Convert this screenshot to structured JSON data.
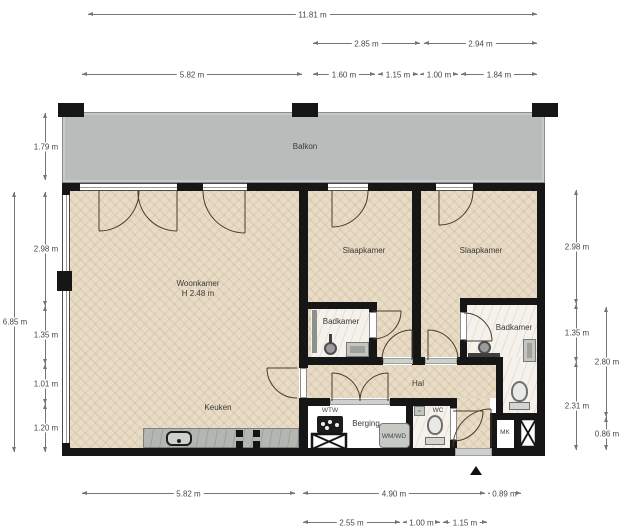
{
  "plan": {
    "type": "apartment-floorplan",
    "rooms": [
      {
        "id": "balkon",
        "label": "Balkon",
        "x": 305,
        "y": 147,
        "small": false
      },
      {
        "id": "woonkamer",
        "label": "Woonkamer",
        "sub": "H 2.48 m",
        "x": 198,
        "y": 289,
        "small": false
      },
      {
        "id": "slaapkamer-1",
        "label": "Slaapkamer",
        "x": 364,
        "y": 251,
        "small": false
      },
      {
        "id": "slaapkamer-2",
        "label": "Slaapkamer",
        "x": 481,
        "y": 251,
        "small": false
      },
      {
        "id": "badkamer-1",
        "label": "Badkamer",
        "x": 341,
        "y": 322,
        "small": false
      },
      {
        "id": "badkamer-2",
        "label": "Badkamer",
        "x": 514,
        "y": 328,
        "small": false
      },
      {
        "id": "keuken",
        "label": "Keuken",
        "x": 218,
        "y": 408,
        "small": false
      },
      {
        "id": "hal",
        "label": "Hal",
        "x": 418,
        "y": 384,
        "small": false
      },
      {
        "id": "wtw",
        "label": "WTW",
        "x": 330,
        "y": 411,
        "small": true
      },
      {
        "id": "berging",
        "label": "Berging",
        "x": 366,
        "y": 424,
        "small": false
      },
      {
        "id": "wmwd",
        "label": "WM/WD",
        "x": 394,
        "y": 437,
        "small": true
      },
      {
        "id": "wc",
        "label": "WC",
        "x": 438,
        "y": 411,
        "small": true
      },
      {
        "id": "mk",
        "label": "MK",
        "x": 505,
        "y": 433,
        "small": true
      }
    ],
    "ceiling_height_note": "H 2.48 m"
  },
  "dimensions": {
    "top": [
      {
        "label": "11.81 m",
        "x1": 88,
        "x2": 537,
        "y": 14
      },
      {
        "label": "2.85 m",
        "x1": 313,
        "x2": 420,
        "y": 43
      },
      {
        "label": "2.94 m",
        "x1": 424,
        "x2": 537,
        "y": 43
      },
      {
        "label": "5.82 m",
        "x1": 82,
        "x2": 302,
        "y": 74
      },
      {
        "label": "1.60 m",
        "x1": 313,
        "x2": 375,
        "y": 74
      },
      {
        "label": "1.15 m",
        "x1": 378,
        "x2": 418,
        "y": 74
      },
      {
        "label": "1.00 m",
        "x1": 420,
        "x2": 458,
        "y": 74
      },
      {
        "label": "1.84 m",
        "x1": 461,
        "x2": 537,
        "y": 74
      }
    ],
    "bottom": [
      {
        "label": "5.82 m",
        "x1": 82,
        "x2": 295,
        "y": 493
      },
      {
        "label": "4.90 m",
        "x1": 303,
        "x2": 485,
        "y": 493
      },
      {
        "label": "0.89 m",
        "x1": 488,
        "x2": 521,
        "y": 493
      },
      {
        "label": "2.55 m",
        "x1": 303,
        "x2": 400,
        "y": 522
      },
      {
        "label": "1.00 m",
        "x1": 403,
        "x2": 440,
        "y": 522
      },
      {
        "label": "1.15 m",
        "x1": 443,
        "x2": 487,
        "y": 522
      }
    ],
    "left": [
      {
        "label": "1.79 m",
        "x": 45,
        "y1": 113,
        "y2": 180
      },
      {
        "label": "2.98 m",
        "x": 45,
        "y1": 192,
        "y2": 306
      },
      {
        "label": "1.35 m",
        "x": 45,
        "y1": 306,
        "y2": 364
      },
      {
        "label": "1.01 m",
        "x": 45,
        "y1": 364,
        "y2": 404
      },
      {
        "label": "1.20 m",
        "x": 45,
        "y1": 404,
        "y2": 452
      },
      {
        "label": "6.85 m",
        "x": 14,
        "y1": 192,
        "y2": 452
      }
    ],
    "right": [
      {
        "label": "2.98 m",
        "x": 576,
        "y1": 190,
        "y2": 304
      },
      {
        "label": "1.35 m",
        "x": 576,
        "y1": 304,
        "y2": 362
      },
      {
        "label": "2.31 m",
        "x": 576,
        "y1": 362,
        "y2": 450
      },
      {
        "label": "2.80 m",
        "x": 606,
        "y1": 307,
        "y2": 417
      },
      {
        "label": "0.86 m",
        "x": 606,
        "y1": 417,
        "y2": 450
      }
    ]
  },
  "colors": {
    "wall": "#161616",
    "balcony": "#b8bcbb",
    "wood_floor": "#e9dcc6",
    "tile_floor": "#f5f2ec",
    "counter": "#b4b7b1",
    "dimension_line": "#757575"
  }
}
